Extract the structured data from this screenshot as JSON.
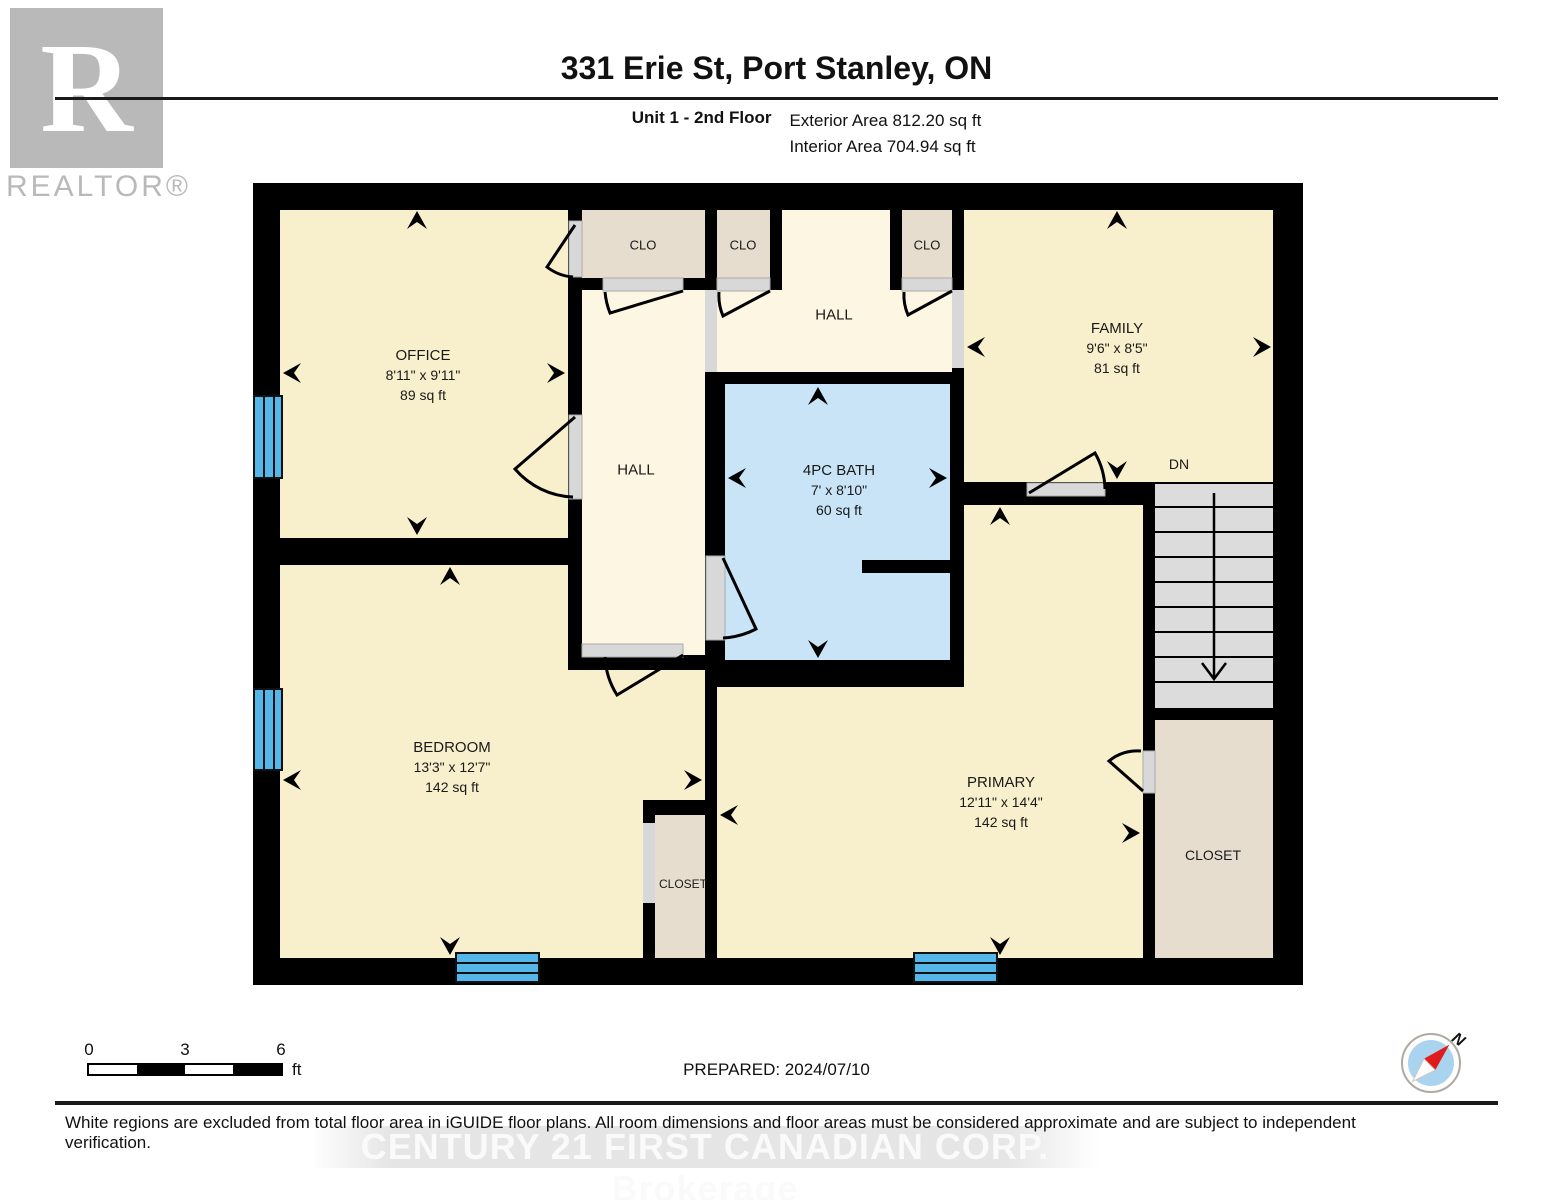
{
  "header": {
    "title": "331 Erie St, Port Stanley, ON",
    "unit_label": "Unit 1 - 2nd Floor",
    "exterior_area": "Exterior Area 812.20 sq ft",
    "interior_area": "Interior Area 704.94 sq ft"
  },
  "branding": {
    "realtor_letter": "R",
    "realtor_wordmark": "REALTOR®",
    "watermark": "CENTURY 21 FIRST CANADIAN CORP. Brokerage"
  },
  "rooms": {
    "office": {
      "name": "OFFICE",
      "dims": "8'11\" x 9'11\"",
      "area": "89 sq ft"
    },
    "family": {
      "name": "FAMILY",
      "dims": "9'6\" x 8'5\"",
      "area": "81 sq ft"
    },
    "bath": {
      "name": "4PC BATH",
      "dims": "7' x 8'10\"",
      "area": "60 sq ft"
    },
    "bedroom": {
      "name": "BEDROOM",
      "dims": "13'3\" x 12'7\"",
      "area": "142 sq ft"
    },
    "primary": {
      "name": "PRIMARY",
      "dims": "12'11\" x 14'4\"",
      "area": "142 sq ft"
    }
  },
  "labels": {
    "clo": "CLO",
    "hall": "HALL",
    "closet": "CLOSET",
    "down": "DN"
  },
  "scale_bar": {
    "start": "0",
    "mid": "3",
    "end": "6",
    "unit": "ft"
  },
  "compass": {
    "north": "N"
  },
  "footer": {
    "prepared": "PREPARED: 2024/07/10",
    "disclaimer": "White regions are excluded from total floor area in iGUIDE floor plans. All room dimensions and floor areas must be considered approximate and are subject to independent verification."
  },
  "colors": {
    "wall": "#000000",
    "room_fill": "#f8efcc",
    "hall_fill": "#fcf6e2",
    "closet_fill": "#e6ddcf",
    "bath_fill": "#c8e4f6",
    "stair_fill": "#dcdcdc",
    "window_blue": "#54b6e9",
    "door_gray": "#d8d8d8"
  }
}
